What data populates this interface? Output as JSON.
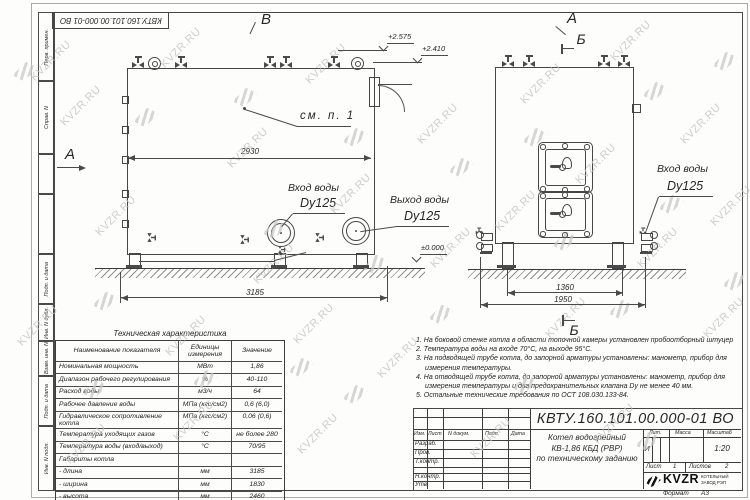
{
  "watermark": {
    "text": "KVZR.RU"
  },
  "stamp": {
    "doc_number": "КВТУ.160.101.00.000-01 ВО"
  },
  "margin": {
    "labels": [
      "Перв. примен.",
      "Справ. N",
      "Подп. и дата",
      "Инв. N дубл.",
      "Взам. инв. N",
      "Подп. и дата",
      "Инв. N подл."
    ]
  },
  "views": {
    "label_view_b": "В",
    "label_view_a_left": "А",
    "label_view_a_top": "А",
    "label_section_b_top": "Б",
    "label_section_b_bottom": "Б",
    "see_note": "см. п. 1",
    "inlet_label": "Вход воды",
    "inlet_dn": "Dy125",
    "outlet_label": "Выход воды",
    "outlet_dn": "Dy125",
    "inlet_right_label": "Вход воды",
    "inlet_right_dn": "Dy125",
    "elev_top1": "+2.575",
    "elev_top2": "+2.410",
    "elev_zero": "±0.000",
    "dim_2930": "2930",
    "dim_3185": "3185",
    "dim_1360": "1360",
    "dim_1950": "1950"
  },
  "table": {
    "title": "Техническая характеристика",
    "headers": [
      "Наименование показателя",
      "Единицы измерения",
      "Значение"
    ],
    "rows": [
      {
        "name": "Номинальная мощность",
        "unit": "МВт",
        "value": "1,86"
      },
      {
        "name": "Диапазон рабочего регулирования",
        "unit": "%",
        "value": "40-110"
      },
      {
        "name": "Расход воды",
        "unit": "м3/ч",
        "value": "64"
      },
      {
        "name": "Рабочее давление воды",
        "unit": "МПа (кгс/см2)",
        "value": "0,6 (6,0)"
      },
      {
        "name": "Гидравлическое сопротивление котла",
        "unit": "МПа (кгс/см2)",
        "value": "0,06 (0,6)"
      },
      {
        "name": "Температура уходящих газов",
        "unit": "°С",
        "value": "не более 280"
      },
      {
        "name": "Температура воды (вход/выход)",
        "unit": "°С",
        "value": "70/95"
      },
      {
        "name": "Габариты котла",
        "unit": "",
        "value": ""
      },
      {
        "name": "  - длина",
        "unit": "мм",
        "value": "3185"
      },
      {
        "name": "  - ширина",
        "unit": "мм",
        "value": "1830"
      },
      {
        "name": "  - высота",
        "unit": "мм",
        "value": "2460"
      }
    ]
  },
  "notes": {
    "items": [
      {
        "n": "1.",
        "text": "На боковой стенке котла в области топочной камеры установлен пробоотборный штуцер"
      },
      {
        "n": "2.",
        "text": "Температура воды на входе 70°С, на выходе 95°С."
      },
      {
        "n": "3.",
        "text": "На подводящей трубе котла, до запорной арматуры установлены: манометр, прибор для измерения температуры."
      },
      {
        "n": "4.",
        "text": "На отводящей трубе котла, до запорной арматуры установлены: манометр, прибор для измерения температуры и два предохранительных клапана Dy не менее 40 мм."
      },
      {
        "n": "5.",
        "text": "Остальные технические требования по ОСТ 108.030.133-84."
      }
    ]
  },
  "titleblock": {
    "doc_number": "КВТУ.160.101.00.000-01 ВО",
    "col_izm": "Изм.",
    "col_list": "Лист",
    "col_ndoc": "N докум.",
    "col_podp": "Подп.",
    "col_data": "Дата",
    "role_razrab": "Разраб.",
    "role_prov": "Пров.",
    "role_tkontr": "Т.контр.",
    "role_nkontr": "Н.контр.",
    "role_utv": "Утв.",
    "name_line1": "Котел водогрейный",
    "name_line2": "КВ-1,86 КБД (РВР)",
    "name_line3": "по техническому заданию",
    "lit_label": "Лит.",
    "mass_label": "Масса",
    "scale_label": "Масштаб",
    "lit_value": "И",
    "mass_value": "",
    "scale_value": "1:20",
    "sheet_label": "Лист",
    "sheet_value": "1",
    "sheets_label": "Листов",
    "sheets_value": "2",
    "logo_text": "KVZR",
    "company_line1": "КОТЕЛЬНЫЙ",
    "company_line2": "ЗАВОД РЭП",
    "format_label": "Формат",
    "format_value": "А3"
  }
}
